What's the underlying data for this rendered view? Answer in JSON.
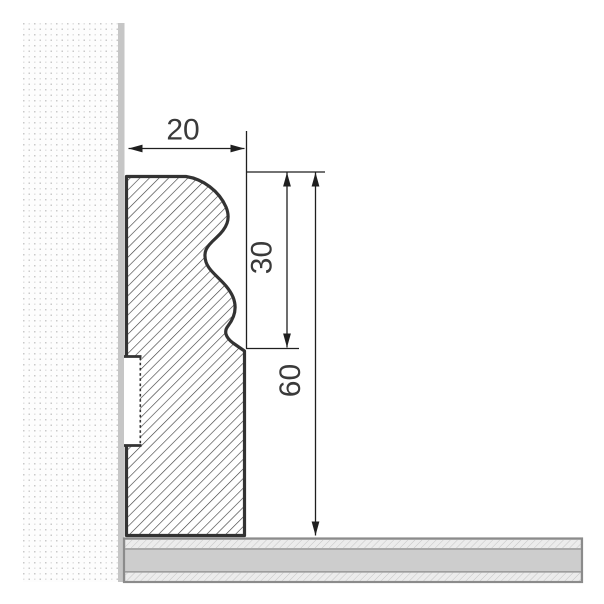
{
  "diagram": {
    "type": "technical-drawing",
    "title": "Skirting board profile cross-section against wall and floor",
    "parts": [
      "wall",
      "wall-edge-strip",
      "skirting-profile",
      "rear-groove",
      "floor"
    ],
    "dimensions": [
      {
        "id": "profile-depth",
        "label": "20",
        "value": 20,
        "unit": "mm",
        "orientation": "horizontal"
      },
      {
        "id": "upper-height",
        "label": "30",
        "value": 30,
        "unit": "mm",
        "orientation": "vertical"
      },
      {
        "id": "total-height",
        "label": "60",
        "value": 60,
        "unit": "mm",
        "orientation": "vertical"
      }
    ]
  },
  "colors": {
    "background": "#ffffff",
    "outline": "#333333",
    "hatch_line": "#3d3d3d",
    "dimension_line": "#1f1f1f",
    "text": "#3a3a3a",
    "wall_dot": "#c9c9c9",
    "wall_strip": "#c6c6c6",
    "floor_border": "#8b8b8b",
    "floor_fill": "#cdcdcd",
    "floor_hatch_bg": "#ececec",
    "floor_hatch_line": "#c5c5c5"
  }
}
